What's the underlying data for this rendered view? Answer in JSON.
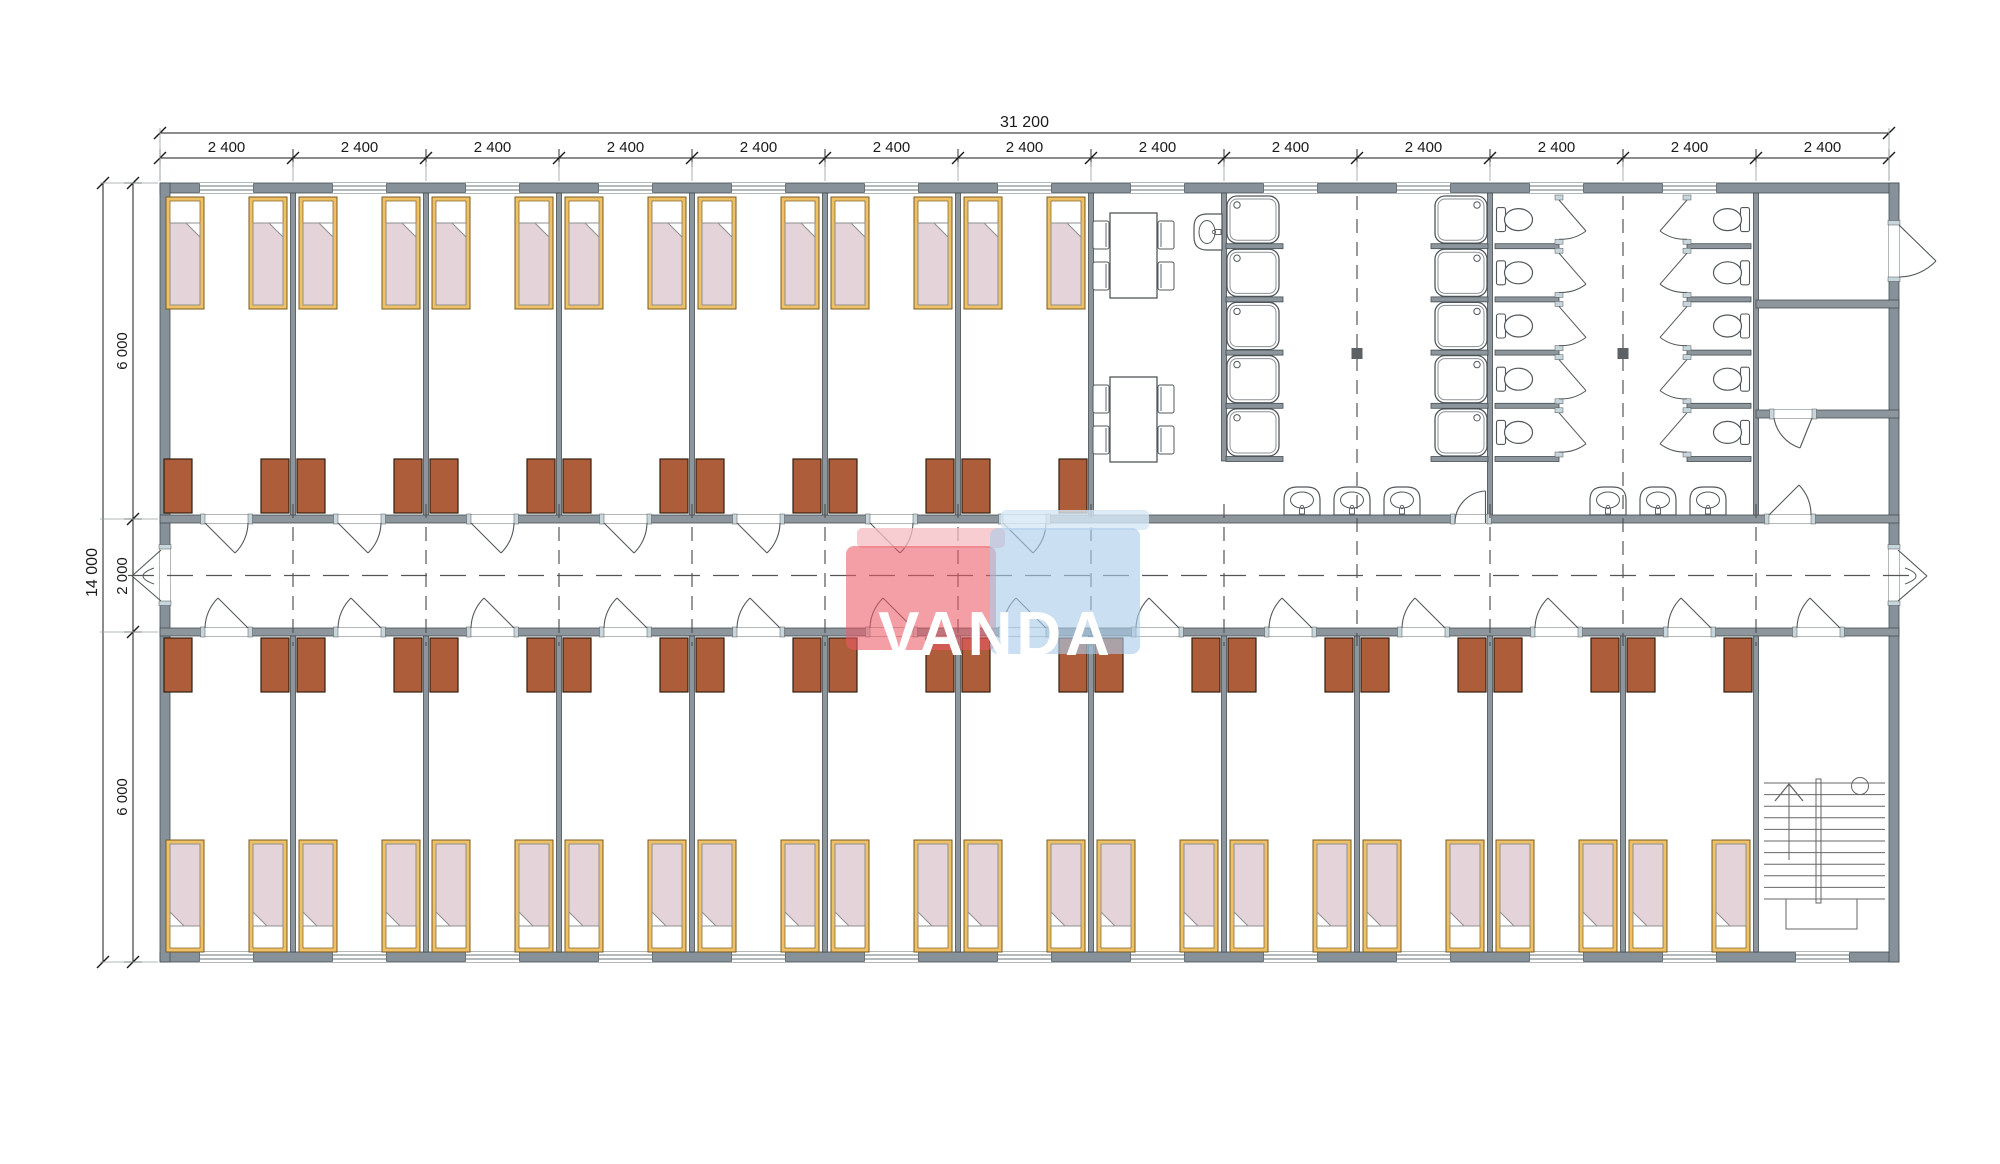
{
  "watermark": {
    "text": "VANDA",
    "red": "#ea5964",
    "red_top": "#f4bcc1",
    "blue": "#a9cce9",
    "blue_top": "#d6e7f5",
    "text_color": "#ffffff"
  },
  "dimensions": {
    "top_total": "31 200",
    "bay_label": "2 400",
    "bay_count": 13,
    "left_total": "14 000",
    "left_segments": [
      "6 000",
      "2 000",
      "6 000"
    ]
  },
  "plan": {
    "top_bedrooms": 7,
    "bottom_bedrooms": 12,
    "beds_per_room": 2,
    "shower_stalls": 10,
    "toilet_stalls": 10,
    "wash_basins": 7,
    "dining_tables": 2,
    "chairs_per_table": 4,
    "stair_flights": 1
  },
  "colors": {
    "wall": "#8c969c",
    "wall_ext": "#87919a",
    "wall_light": "#aebfc6",
    "stub": "#c6d6dc",
    "bed_frame": "#efc166",
    "bed_frame_stroke": "#7a5a20",
    "blanket": "#e5d3da",
    "blanket_stroke": "#8f8f8f",
    "wardrobe": "#ae5d3b",
    "wardrobe_stroke": "#33200f",
    "fixture": "#51585c",
    "dim": "#1a1a1a",
    "dim_light": "#9aa0a4",
    "dash": "#555555"
  }
}
